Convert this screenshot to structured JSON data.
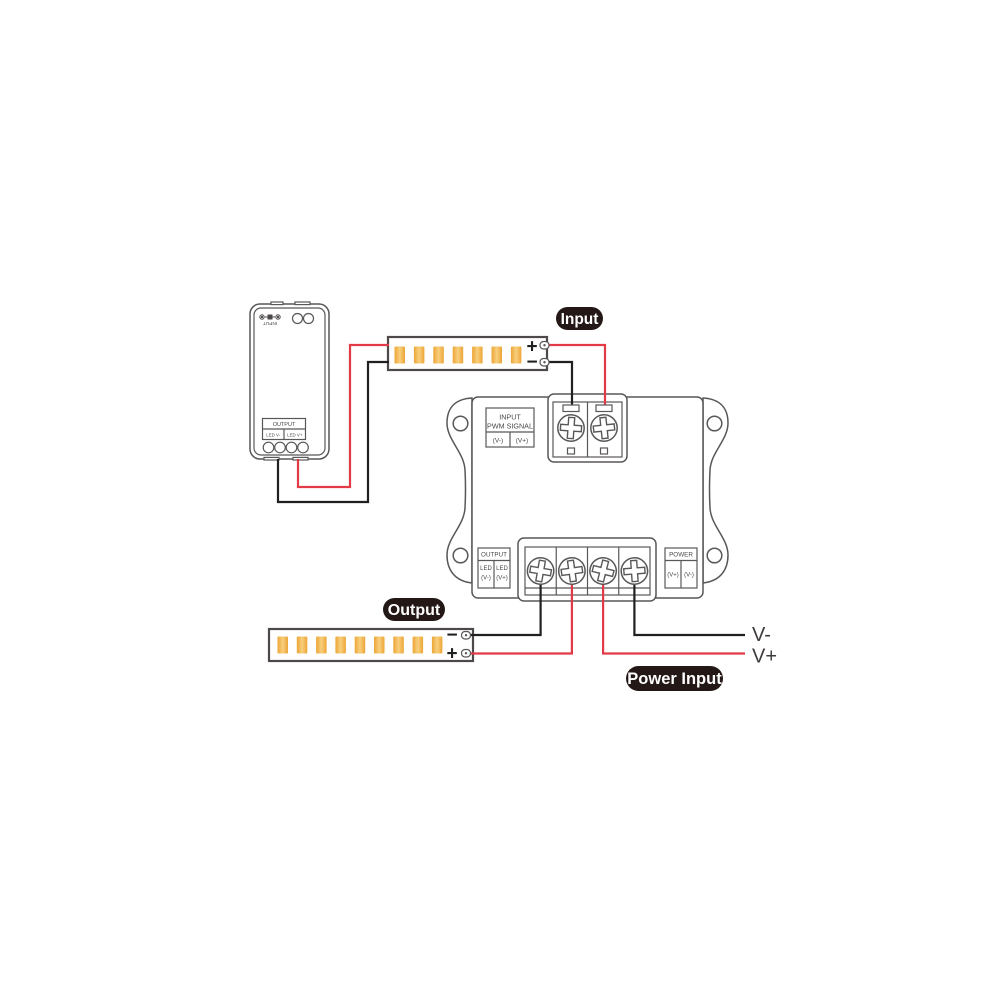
{
  "badges": {
    "input": "Input",
    "output": "Output",
    "power_input": "Power Input"
  },
  "labels": {
    "v_minus": "V-",
    "v_plus": "V+"
  },
  "controller": {
    "port_label": "INPUT",
    "output_header": "OUTPUT",
    "output_col_neg": "LED V-",
    "output_col_pos": "LED V+"
  },
  "amplifier": {
    "input_block": {
      "line1": "INPUT",
      "line2": "PWM SIGNAL",
      "cell_neg": "(V-)",
      "cell_pos": "(V+)"
    },
    "output_block": {
      "header": "OUTPUT",
      "cell1_line1": "LED",
      "cell1_line2": "(V-)",
      "cell2_line1": "LED",
      "cell2_line2": "(V+)"
    },
    "power_block": {
      "header": "POWER",
      "cell_pos": "(V+)",
      "cell_neg": "(V-)"
    }
  },
  "strips": {
    "top": {
      "plus": "+",
      "minus": "−",
      "led_count": 7
    },
    "bottom": {
      "plus": "+",
      "minus": "−",
      "led_count": 9
    }
  },
  "colors": {
    "wire_red": "#e23b47",
    "wire_black": "#221f1f",
    "outline": "#595757",
    "led_chip": "#f2b13d",
    "badge_bg": "#231815",
    "badge_text": "#ffffff"
  }
}
